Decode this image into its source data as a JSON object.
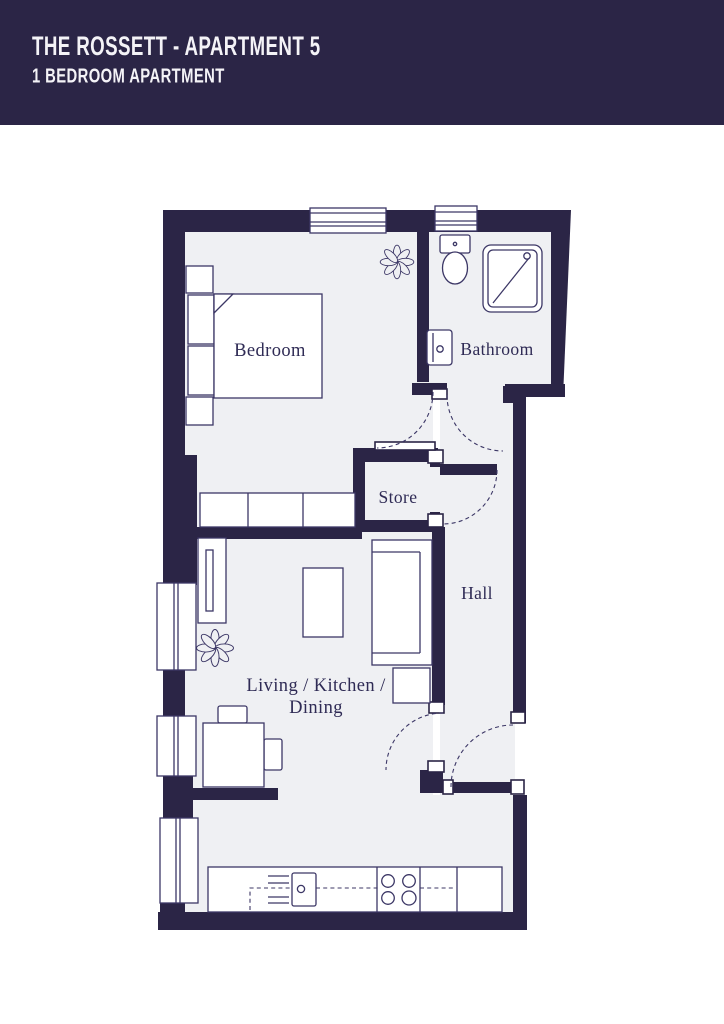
{
  "header": {
    "title": "THE ROSSETT - APARTMENT 5",
    "subtitle": "1 BEDROOM APARTMENT"
  },
  "plan": {
    "rooms": {
      "bedroom": "Bedroom",
      "bathroom": "Bathroom",
      "store": "Store",
      "hall": "Hall",
      "living_line1": "Living / Kitchen /",
      "living_line2": "Dining"
    }
  },
  "colors": {
    "wall": "#2b2546",
    "floor": "#eff0f3",
    "line": "#3c3766",
    "label": "#2f2b55",
    "header_bg": "#2b2546",
    "header_text": "#f4f3f7",
    "page_bg": "#ffffff"
  }
}
